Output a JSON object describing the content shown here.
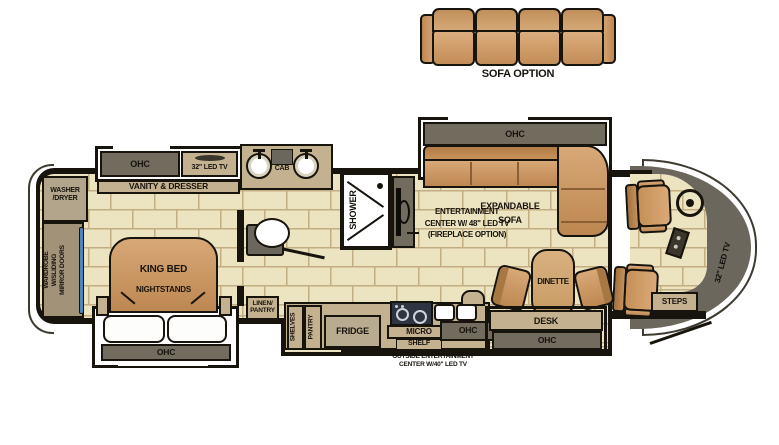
{
  "palette": {
    "floor": "#ece3c0",
    "grout": "#c3ae83",
    "wall": "#17130d",
    "cab": "#716c5d",
    "counter": "#c4b190",
    "tanL": "#d8a877",
    "tanD": "#bd8751",
    "cap": "#6c675c",
    "mirror": "#4e85bf",
    "cooktop": "#2e3542"
  },
  "labels": {
    "sofa_option": "SOFA OPTION",
    "washer_dryer": "WASHER\n/DRYER",
    "wardrobe": "WARDROBE\nW/SLIDING\nMIRROR DOORS",
    "bedroom_ohc": "OHC",
    "bedroom_tv": "32\" LED TV",
    "vanity_dresser": "VANITY & DRESSER",
    "king_bed": "KING BED",
    "nightstands": "NIGHTSTANDS",
    "bed_ohc": "OHC",
    "cab": "CAB",
    "shower": "SHOWER",
    "linen_pantry": "LINEN/\nPANTRY",
    "entertainment": "ENTERTAINMENT\nCENTER W/ 48\" LED TV\n(FIREPLACE OPTION)",
    "sofa_ohc": "OHC",
    "expandable_sofa": "EXPANDABLE\nSOFA",
    "dinette": "DINETTE",
    "desk": "DESK",
    "desk_ohc": "OHC",
    "shelves": "SHELVES",
    "pantry": "PANTRY",
    "fridge": "FRIDGE",
    "micro": "MICRO",
    "shelf": "SHELF",
    "kitchen_ohc": "OHC",
    "outside_entertainment": "OUTSIDE ENTERTAINMENT\nCENTER W/40\" LED TV",
    "front_tv": "32\" LED TV",
    "steps": "STEPS"
  }
}
